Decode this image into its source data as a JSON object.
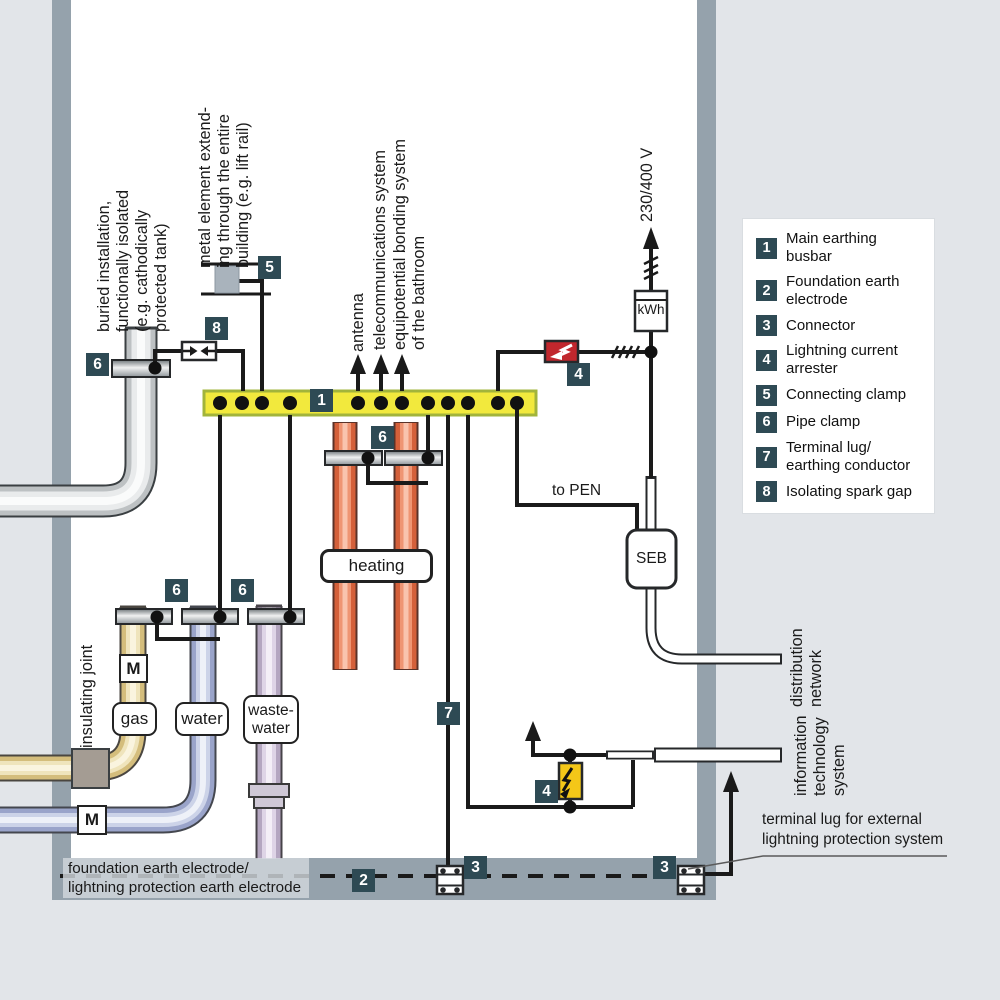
{
  "legend": {
    "items": [
      {
        "num": "1",
        "label": "Main earthing busbar"
      },
      {
        "num": "2",
        "label": "Foundation earth\nelectrode"
      },
      {
        "num": "3",
        "label": "Connector"
      },
      {
        "num": "4",
        "label": "Lightning current\narrester"
      },
      {
        "num": "5",
        "label": "Connecting clamp"
      },
      {
        "num": "6",
        "label": "Pipe clamp"
      },
      {
        "num": "7",
        "label": "Terminal lug/\nearthing conductor"
      },
      {
        "num": "8",
        "label": "Isolating spark gap"
      }
    ]
  },
  "markers": {
    "busbar": "1",
    "foundation_electrode": "2",
    "connector_a": "3",
    "connector_b": "3",
    "arrester_top": "4",
    "arrester_bottom": "4",
    "connecting_clamp": "5",
    "clamp_buried": "6",
    "clamp_heating": "6",
    "clamp_gas_water": "6",
    "clamp_waste": "6",
    "terminal_lug": "7",
    "spark_gap": "8"
  },
  "labels": {
    "buried": "buried installation,\nfunctionally isolated\n(e.g. cathodically\nprotected tank)",
    "metal_element": "metal element extend-\ning through the entire\nbuilding (e.g. lift rail)",
    "antenna": "antenna",
    "telecom": "telecommunications system",
    "equipotential": "equipotential bonding system\nof the bathroom",
    "voltage": "230/400 V",
    "insulating_joint": "insulating joint",
    "to_pen": "to PEN",
    "distribution": "distribution\nnetwork",
    "infotech": "information\ntechnology\nsystem",
    "terminal_lug_ext": "terminal lug for external\nlightning protection system",
    "foundation": "foundation earth electrode/\nlightning protection earth electrode"
  },
  "boxes": {
    "heating": "heating",
    "gas": "gas",
    "water": "water",
    "wastewater": "waste-\nwater",
    "meter_gas": "M",
    "meter_water": "M",
    "kwh": "kWh",
    "seb": "SEB"
  },
  "colors": {
    "badge": "#2e4a54",
    "busbar_fill": "#f2e93d",
    "busbar_border": "#a2b43b",
    "arrester_red": "#c1272d",
    "arrester_yellow": "#f4c718",
    "wall": "#95a2ac",
    "outside": "#e2e5e9"
  }
}
